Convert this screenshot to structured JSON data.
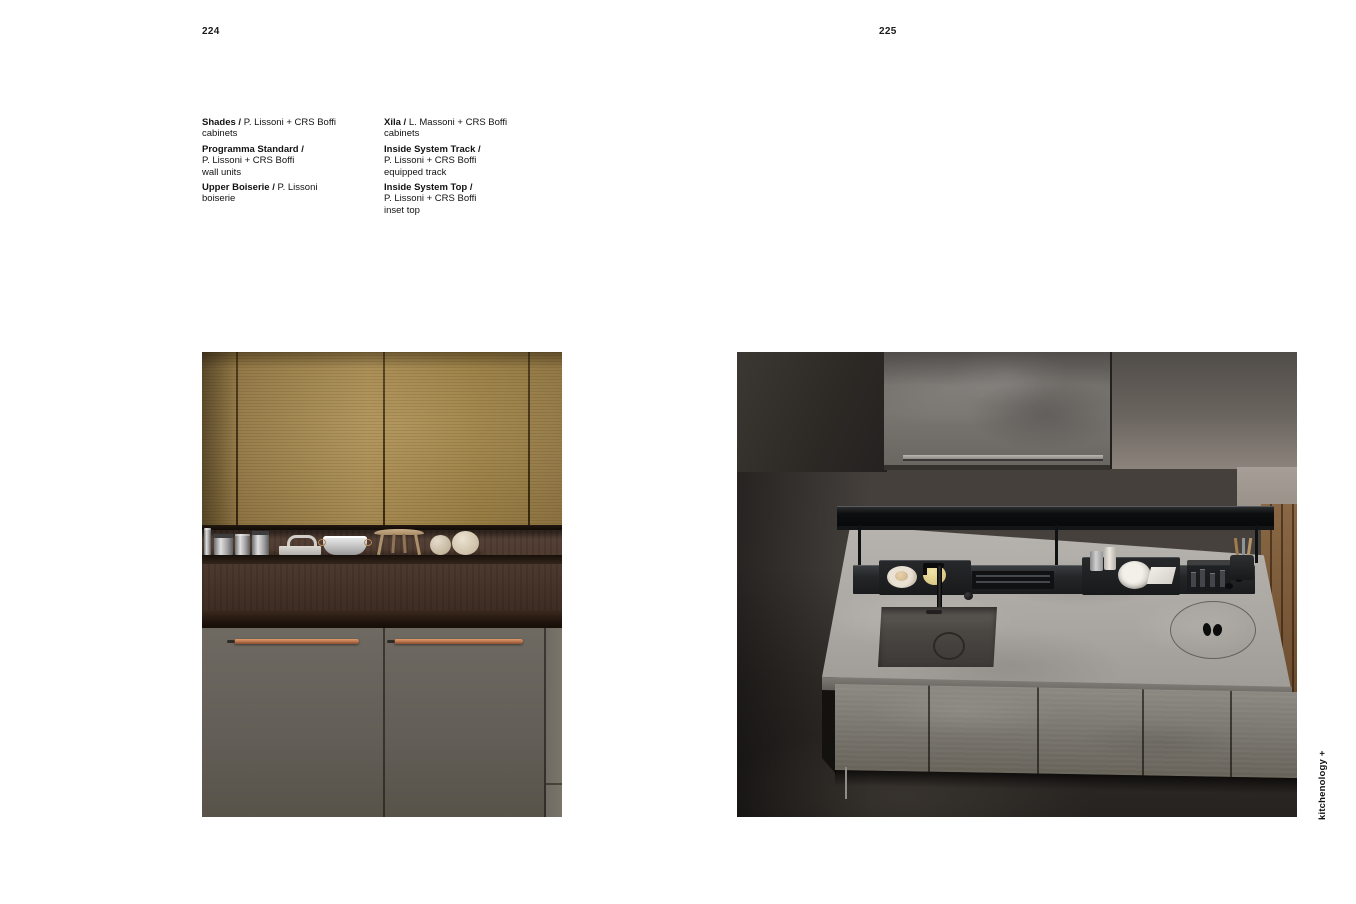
{
  "page": {
    "left_number": "224",
    "right_number": "225",
    "side_label": "kitchenology +"
  },
  "captions": {
    "left": [
      {
        "title": "Shades /",
        "inline": "P. Lissoni + CRS Boffi",
        "lines": [
          "cabinets"
        ]
      },
      {
        "title": "Programma Standard /",
        "inline": "",
        "lines": [
          "P. Lissoni + CRS Boffi",
          "wall units"
        ]
      },
      {
        "title": "Upper Boiserie /",
        "inline": "P. Lissoni",
        "lines": [
          "boiserie"
        ]
      }
    ],
    "right": [
      {
        "title": "Xila /",
        "inline": "L. Massoni + CRS Boffi",
        "lines": [
          "cabinets"
        ]
      },
      {
        "title": "Inside System Track /",
        "inline": "",
        "lines": [
          "P. Lissoni + CRS Boffi",
          "equipped track"
        ]
      },
      {
        "title": "Inside System Top /",
        "inline": "",
        "lines": [
          "P. Lissoni + CRS Boffi",
          "inset top"
        ]
      }
    ]
  },
  "palette": {
    "page_background": "#ffffff",
    "text": "#141414",
    "gold_cabinet": "#9a7d4a",
    "walnut_wood": "#4a372b",
    "grey_door": "#625e57",
    "copper_handle": "#b5714a",
    "stone_counter": "#aba7a2",
    "stone_front": "#7b7771",
    "black_shelf": "#0d0e10",
    "dark_room": "#2c2925",
    "oak_wood_strip": "#7b5a3b"
  }
}
